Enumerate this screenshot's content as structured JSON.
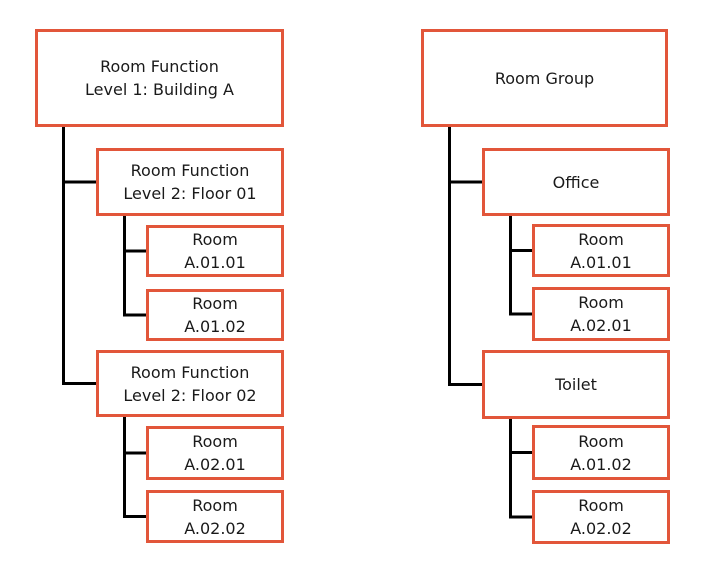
{
  "diagram": {
    "left_tree": {
      "root": {
        "label": "Room Function\nLevel 1: Building A"
      },
      "children": [
        {
          "label": "Room Function\nLevel 2: Floor 01",
          "children": [
            {
              "label": "Room\nA.01.01"
            },
            {
              "label": "Room\nA.01.02"
            }
          ]
        },
        {
          "label": "Room Function\nLevel 2: Floor 02",
          "children": [
            {
              "label": "Room\nA.02.01"
            },
            {
              "label": "Room\nA.02.02"
            }
          ]
        }
      ]
    },
    "right_tree": {
      "root": {
        "label": "Room Group"
      },
      "children": [
        {
          "label": "Office",
          "children": [
            {
              "label": "Room\nA.01.01"
            },
            {
              "label": "Room\nA.02.01"
            }
          ]
        },
        {
          "label": "Toilet",
          "children": [
            {
              "label": "Room\nA.01.02"
            },
            {
              "label": "Room\nA.02.02"
            }
          ]
        }
      ]
    },
    "colors": {
      "box_border": "#E2563A",
      "connector": "#000000",
      "text": "#1a1a1a",
      "background": "#ffffff"
    }
  }
}
